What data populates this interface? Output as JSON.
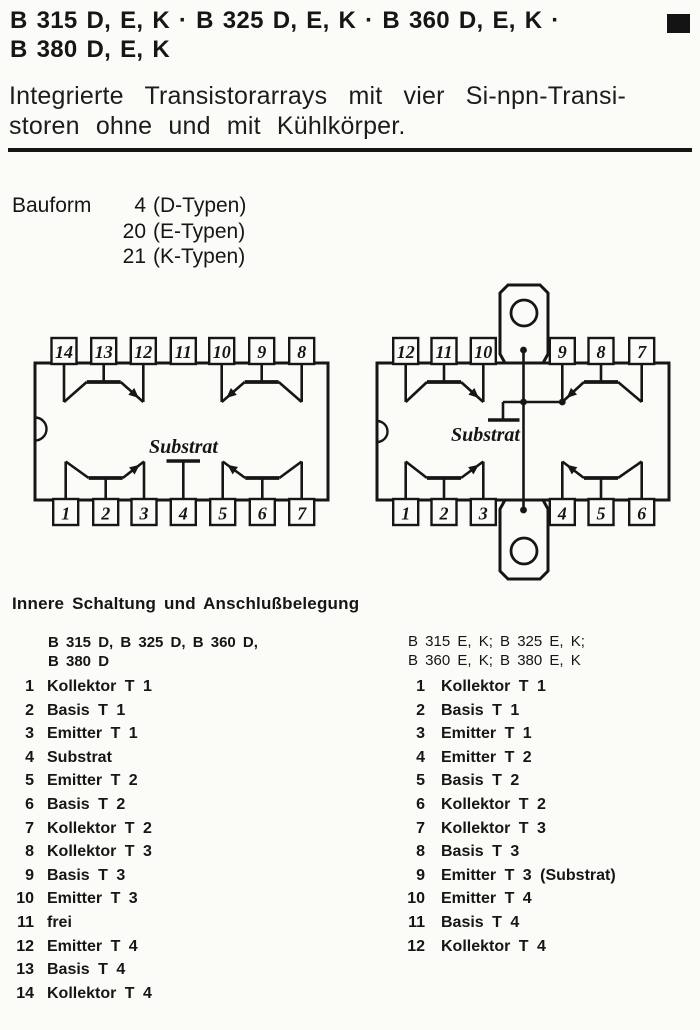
{
  "colors": {
    "ink": "#151515",
    "paper": "#fbfbf8"
  },
  "header": {
    "title_line1": "B 315 D, E, K · B 325 D, E, K · B 360 D, E, K ·",
    "title_line2": "B 380 D, E, K",
    "subtitle_line1": "Integrierte Transistorarrays mit vier Si-npn-Transi-",
    "subtitle_line2": "storen ohne und mit Kühlkörper."
  },
  "bauform": {
    "label": "Bauform",
    "rows": [
      {
        "num": "4",
        "text": "(D-Typen)"
      },
      {
        "num": "20",
        "text": "(E-Typen)"
      },
      {
        "num": "21",
        "text": "(K-Typen)"
      }
    ]
  },
  "diagrams": {
    "dip14": {
      "top_pins": [
        "14",
        "13",
        "12",
        "11",
        "10",
        "9",
        "8"
      ],
      "bottom_pins": [
        "1",
        "2",
        "3",
        "4",
        "5",
        "6",
        "7"
      ],
      "substrate_label": "Substrat"
    },
    "dip12k": {
      "top_pins": [
        "12",
        "11",
        "10",
        "9",
        "8",
        "7"
      ],
      "bottom_pins": [
        "1",
        "2",
        "3",
        "4",
        "5",
        "6"
      ],
      "substrate_label": "Substrat"
    }
  },
  "pinout": {
    "heading": "Innere Schaltung und Anschlußbelegung",
    "left": {
      "header_line1": "B 315 D, B 325 D, B 360 D,",
      "header_line2": "B 380 D",
      "pins": [
        {
          "num": "1",
          "label": "Kollektor T 1"
        },
        {
          "num": "2",
          "label": "Basis T 1"
        },
        {
          "num": "3",
          "label": "Emitter T 1"
        },
        {
          "num": "4",
          "label": "Substrat"
        },
        {
          "num": "5",
          "label": "Emitter T 2"
        },
        {
          "num": "6",
          "label": "Basis T 2"
        },
        {
          "num": "7",
          "label": "Kollektor T 2"
        },
        {
          "num": "8",
          "label": "Kollektor T 3"
        },
        {
          "num": "9",
          "label": "Basis T 3"
        },
        {
          "num": "10",
          "label": "Emitter T 3"
        },
        {
          "num": "11",
          "label": "frei"
        },
        {
          "num": "12",
          "label": "Emitter T 4"
        },
        {
          "num": "13",
          "label": "Basis T 4"
        },
        {
          "num": "14",
          "label": "Kollektor T 4"
        }
      ]
    },
    "right": {
      "header_line1": "B 315 E, K; B 325 E, K;",
      "header_line2": "B 360 E, K; B 380 E, K",
      "pins": [
        {
          "num": "1",
          "label": "Kollektor T 1"
        },
        {
          "num": "2",
          "label": "Basis T 1"
        },
        {
          "num": "3",
          "label": "Emitter T 1"
        },
        {
          "num": "4",
          "label": "Emitter T 2"
        },
        {
          "num": "5",
          "label": "Basis T 2"
        },
        {
          "num": "6",
          "label": "Kollektor T 2"
        },
        {
          "num": "7",
          "label": "Kollektor T 3"
        },
        {
          "num": "8",
          "label": "Basis T 3"
        },
        {
          "num": "9",
          "label": "Emitter T 3 (Substrat)"
        },
        {
          "num": "10",
          "label": "Emitter T 4"
        },
        {
          "num": "11",
          "label": "Basis T 4"
        },
        {
          "num": "12",
          "label": "Kollektor T 4"
        }
      ]
    }
  }
}
